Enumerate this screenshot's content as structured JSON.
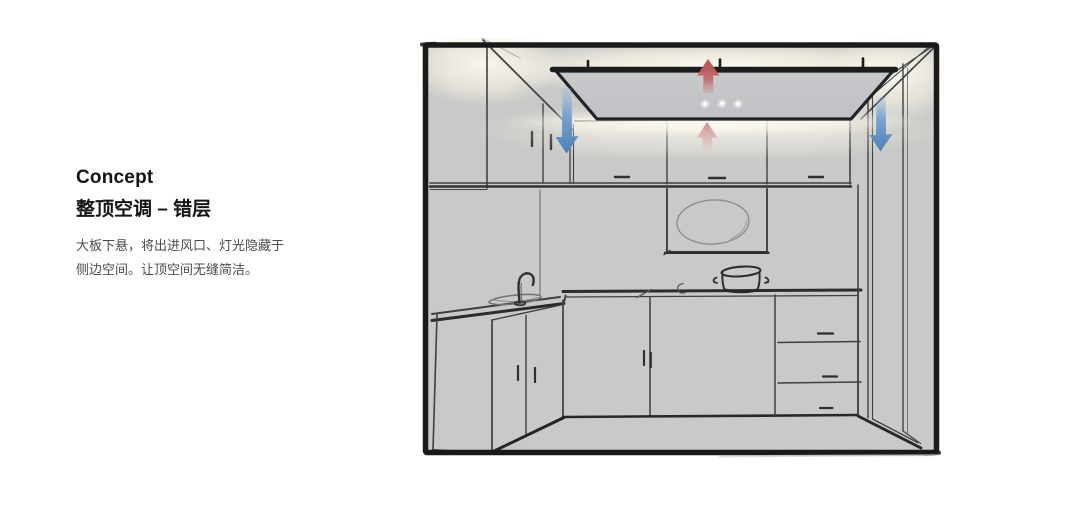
{
  "slide": {
    "heading": "Concept",
    "subheading": "整顶空调 – 错层",
    "description_lines": [
      "大板下悬，将出进风口、灯光隐藏于",
      "侧边空间。让顶空间无缝简洁。"
    ]
  },
  "sketch": {
    "name": "kitchen-ceiling-ac-concept-sketch",
    "elements": [
      "suspended-ac-panel",
      "panel-mount-brackets",
      "panel-indicator-lights",
      "hidden-edge-lighting-glow",
      "upper-cabinets",
      "range-hood",
      "cooking-pot",
      "sink-and-faucet",
      "base-cabinets",
      "drawer-unit",
      "right-doorway",
      "floor"
    ],
    "airflow_arrows": [
      {
        "name": "return-air-up-arrow-top",
        "direction": "up",
        "color": "#c2595c"
      },
      {
        "name": "return-air-up-arrow-center",
        "direction": "up",
        "color": "#d08a8c"
      },
      {
        "name": "supply-air-down-arrow-left",
        "direction": "down",
        "color": "#6b9cd1"
      },
      {
        "name": "supply-air-down-arrow-right",
        "direction": "down",
        "color": "#6b9cd1"
      }
    ],
    "panel_light_dot_count": 3
  },
  "colors": {
    "background": "#ffffff",
    "text_primary": "#151515",
    "text_secondary": "#4b4b4b",
    "wall_fill": "#c9cac8",
    "panel_fill": "#c4c6c9",
    "sketch_line": "#3e4043",
    "frame": "#1a1a1b",
    "glow": "#fdf8ec",
    "arrow_blue": "#6b9cd1",
    "arrow_red": "#c2595c"
  }
}
